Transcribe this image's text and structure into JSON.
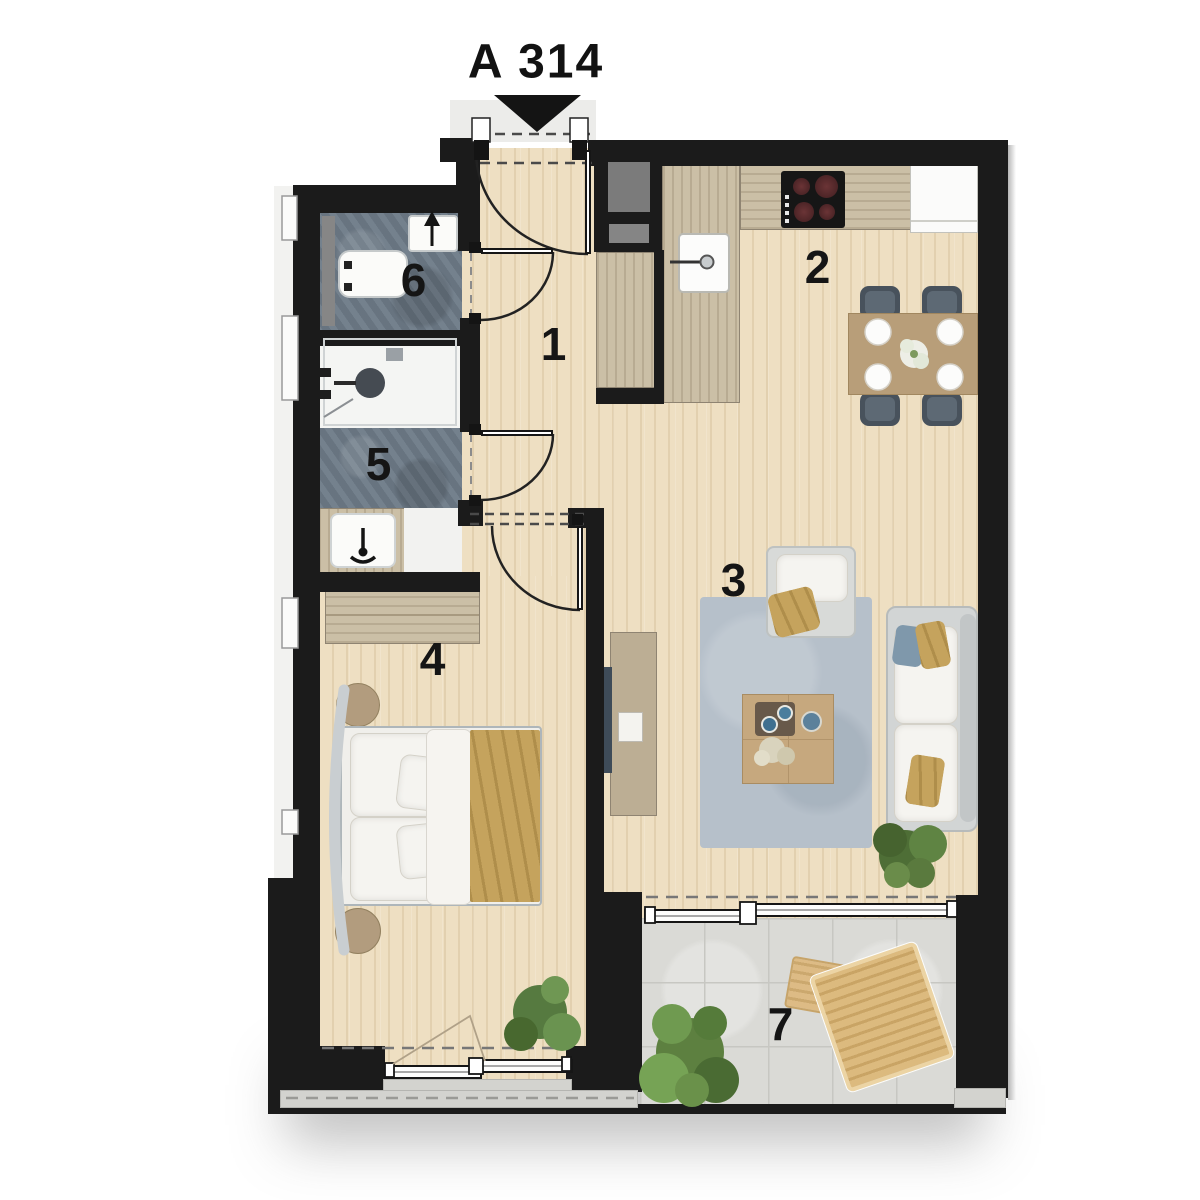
{
  "title": "A 314",
  "rooms": [
    {
      "label": "1"
    },
    {
      "label": "2"
    },
    {
      "label": "3"
    },
    {
      "label": "4"
    },
    {
      "label": "5"
    },
    {
      "label": "6"
    },
    {
      "label": "7"
    }
  ],
  "colors": {
    "wall": "#1b1b1b",
    "wood_floor": "#eedfc2",
    "counter_wood": "#cbbfa6",
    "wet_room_tile": "#6d7a87",
    "rug": "#b6c0ca",
    "balcony_floor": "#dadad6",
    "accent_tan": "#c5a35d",
    "chair_gray": "#48525c",
    "label_text": "#151515"
  }
}
